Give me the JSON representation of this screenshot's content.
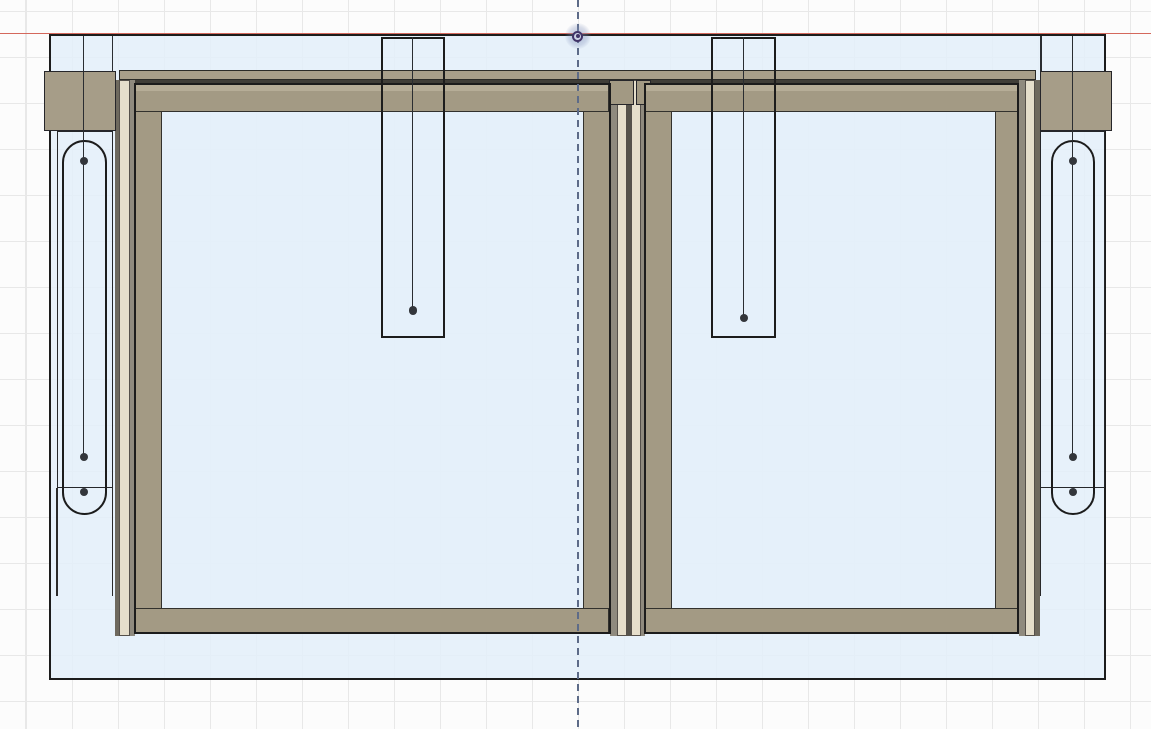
{
  "view": {
    "app_context": "cad-viewport",
    "description": "Front elevation of a double sliding door frame assembly",
    "width": 1151,
    "height": 729,
    "background_color": "#fcfcfc",
    "grid_line_color": "#e8e8e8",
    "grid_spacing_px": 46
  },
  "palette": {
    "outline_ink": "#1c1c1c",
    "body_fill": "rgba(227,239,249,0.85)",
    "glass_fill": "rgba(228,240,250,0.6)",
    "frame_tan": "#a39a84",
    "frame_tan_light": "#b6ad97",
    "block_tan": "#a69d88",
    "head_rail_tan": "#a89f8a",
    "track_cream": "#e5decb",
    "track_gray": "#8f8a7e",
    "track_dark": "#6e695e",
    "axis_line_red": "#d4685c",
    "centerline_blue": "#5d6b88",
    "sketch_point": "#33363b",
    "origin_purple": "#413468"
  },
  "origin_marker": {
    "x": 577.9,
    "y": 36.3,
    "outer_glow_radius": 13,
    "ring_radius": 5.6,
    "dot_radius": 2.2
  },
  "shapes": [
    {
      "name": "x-axis-line",
      "type": "rect",
      "x": 0,
      "y": 32.9,
      "w": 1151,
      "h": 1.6,
      "fill": "#d4685c",
      "inter": "false"
    },
    {
      "name": "assembly-body",
      "type": "rect",
      "x": 49,
      "y": 33.5,
      "w": 1057,
      "h": 646,
      "fill": "rgba(227,239,249,0.85)",
      "stroke": "#1c1c1c",
      "sw": 2,
      "inter": "false"
    },
    {
      "name": "left-bracket-edge-a",
      "type": "vline",
      "x": 57,
      "y": 487.5,
      "h": 108,
      "stroke": "#2a2a2a",
      "sw": 1.4,
      "inter": "false"
    },
    {
      "name": "left-bracket-edge-b",
      "type": "vline",
      "x": 112.6,
      "y": 487.5,
      "h": 108,
      "stroke": "#2a2a2a",
      "sw": 1.4,
      "inter": "false"
    },
    {
      "name": "right-bracket-edge",
      "type": "vline",
      "x": 1040,
      "y": 487.5,
      "h": 108,
      "stroke": "#2a2a2a",
      "sw": 1.4,
      "inter": "false"
    },
    {
      "name": "left-bracket-plate",
      "type": "rect",
      "x": 57,
      "y": 131,
      "w": 56,
      "h": 357,
      "stroke": "#25272a",
      "sw": 1.5,
      "inter": "false"
    },
    {
      "name": "right-bracket-plate",
      "type": "rect",
      "x": 1040,
      "y": 131,
      "w": 64.5,
      "h": 357,
      "stroke": "#25272a",
      "sw": 1.5,
      "inter": "false"
    },
    {
      "name": "head-rail",
      "type": "rect",
      "x": 119,
      "y": 69.8,
      "w": 917,
      "h": 9.8,
      "fill": "#a89f8a",
      "stroke": "#2b2b28",
      "sw": 1.2,
      "inter": "false"
    },
    {
      "name": "head-rail-shadow",
      "type": "rect",
      "x": 119,
      "y": 79.6,
      "w": 917,
      "h": 4.8,
      "fill": "#403e38",
      "inter": "false"
    },
    {
      "name": "left-track-dark",
      "type": "rect",
      "x": 115,
      "y": 79.5,
      "w": 4,
      "h": 556,
      "fill": "#6e695e",
      "inter": "false"
    },
    {
      "name": "left-track-cream",
      "type": "rect",
      "x": 119,
      "y": 79.5,
      "w": 10.5,
      "h": 556.5,
      "fill": "#e5decb",
      "stroke": "#55504a",
      "sw": 1,
      "inter": "false"
    },
    {
      "name": "left-track-gray",
      "type": "rect",
      "x": 129.5,
      "y": 79.5,
      "w": 5,
      "h": 556,
      "fill": "#8f8a7e",
      "inter": "false"
    },
    {
      "name": "center-track-gray-a",
      "type": "rect",
      "x": 610,
      "y": 79.5,
      "w": 6.5,
      "h": 556,
      "fill": "#8f8a7e",
      "inter": "false"
    },
    {
      "name": "center-track-cream-a",
      "type": "rect",
      "x": 616.5,
      "y": 79.5,
      "w": 10.5,
      "h": 556.5,
      "fill": "#e5decb",
      "stroke": "#55504a",
      "sw": 1,
      "inter": "false"
    },
    {
      "name": "center-track-dark",
      "type": "rect",
      "x": 627,
      "y": 79.5,
      "w": 4,
      "h": 556,
      "fill": "#55524b",
      "inter": "false"
    },
    {
      "name": "center-track-cream-b",
      "type": "rect",
      "x": 631,
      "y": 79.5,
      "w": 10,
      "h": 556.5,
      "fill": "#e5decb",
      "stroke": "#55504a",
      "sw": 1,
      "inter": "false"
    },
    {
      "name": "center-track-gray-b",
      "type": "rect",
      "x": 641,
      "y": 79.5,
      "w": 3.5,
      "h": 556,
      "fill": "#8f8a7e",
      "inter": "false"
    },
    {
      "name": "right-track-gray",
      "type": "rect",
      "x": 1018.5,
      "y": 79.5,
      "w": 6,
      "h": 556,
      "fill": "#8f8a7e",
      "inter": "false"
    },
    {
      "name": "right-track-cream",
      "type": "rect",
      "x": 1024.5,
      "y": 79.5,
      "w": 10.5,
      "h": 556.5,
      "fill": "#e5decb",
      "stroke": "#55504a",
      "sw": 1,
      "inter": "false"
    },
    {
      "name": "right-track-dark",
      "type": "rect",
      "x": 1035,
      "y": 79.5,
      "w": 5,
      "h": 556,
      "fill": "#6e695e",
      "inter": "false"
    },
    {
      "name": "left-corner-block",
      "type": "rect",
      "x": 44,
      "y": 70.8,
      "w": 71.5,
      "h": 60.5,
      "fill": "#a69d88",
      "stroke": "#26262a",
      "sw": 1.8,
      "inter": "false"
    },
    {
      "name": "right-corner-block",
      "type": "rect",
      "x": 1040,
      "y": 70.8,
      "w": 71.5,
      "h": 60.5,
      "fill": "#a69d88",
      "stroke": "#26262a",
      "sw": 1.8,
      "inter": "false"
    },
    {
      "name": "center-mullion-block-left",
      "type": "rect",
      "x": 608.5,
      "y": 80,
      "w": 25,
      "h": 24.5,
      "fill": "#a29983",
      "stroke": "#26262a",
      "sw": 1.2,
      "inter": "false"
    },
    {
      "name": "center-mullion-block-right",
      "type": "rect",
      "x": 635.5,
      "y": 80,
      "w": 15.5,
      "h": 24.5,
      "fill": "#a29983",
      "stroke": "#26262a",
      "sw": 1.2,
      "inter": "false"
    },
    {
      "name": "left-door-glass",
      "type": "rect",
      "x": 161.5,
      "y": 112,
      "w": 421.5,
      "h": 496,
      "fill": "rgba(228,240,250,0.6)",
      "inter": "false"
    },
    {
      "name": "left-door-top-rail",
      "type": "rect",
      "x": 134.5,
      "y": 84.3,
      "w": 474.5,
      "h": 27.7,
      "cls": "railtop",
      "stroke": "#32312d",
      "sw": 1.2,
      "inter": "false"
    },
    {
      "name": "left-door-bottom-rail",
      "type": "rect",
      "x": 134.5,
      "y": 608,
      "w": 474.5,
      "h": 25.8,
      "fill": "#a39a84",
      "stroke": "#32312d",
      "sw": 1.2,
      "inter": "false"
    },
    {
      "name": "left-door-left-stile",
      "type": "rect",
      "x": 134.5,
      "y": 110.5,
      "w": 27,
      "h": 498,
      "fill": "#a39a84",
      "stroke": "#32312d",
      "sw": 1.2,
      "inter": "false"
    },
    {
      "name": "left-door-right-stile",
      "type": "rect",
      "x": 583,
      "y": 110.5,
      "w": 26.5,
      "h": 498,
      "fill": "#a39a84",
      "stroke": "#32312d",
      "sw": 1.2,
      "inter": "false"
    },
    {
      "name": "left-door-outline",
      "type": "rect",
      "x": 133.5,
      "y": 83.3,
      "w": 477,
      "h": 551.2,
      "stroke": "#1c1c1c",
      "sw": 2,
      "inter": "false"
    },
    {
      "name": "right-door-glass",
      "type": "rect",
      "x": 671.5,
      "y": 112,
      "w": 323.5,
      "h": 496,
      "fill": "rgba(228,240,250,0.6)",
      "inter": "false"
    },
    {
      "name": "right-door-top-rail",
      "type": "rect",
      "x": 645,
      "y": 84.3,
      "w": 373,
      "h": 27.7,
      "cls": "railtop",
      "stroke": "#32312d",
      "sw": 1.2,
      "inter": "false"
    },
    {
      "name": "right-door-bottom-rail",
      "type": "rect",
      "x": 645,
      "y": 608,
      "w": 373,
      "h": 25.8,
      "fill": "#a39a84",
      "stroke": "#32312d",
      "sw": 1.2,
      "inter": "false"
    },
    {
      "name": "right-door-left-stile",
      "type": "rect",
      "x": 645,
      "y": 110.5,
      "w": 26.5,
      "h": 498,
      "fill": "#a39a84",
      "stroke": "#32312d",
      "sw": 1.2,
      "inter": "false"
    },
    {
      "name": "right-door-right-stile",
      "type": "rect",
      "x": 995,
      "y": 110.5,
      "w": 23.5,
      "h": 498,
      "fill": "#a39a84",
      "stroke": "#32312d",
      "sw": 1.2,
      "inter": "false"
    },
    {
      "name": "right-door-outline",
      "type": "rect",
      "x": 644,
      "y": 83.3,
      "w": 375,
      "h": 551.2,
      "stroke": "#1c1c1c",
      "sw": 2,
      "inter": "false"
    },
    {
      "name": "left-slot",
      "type": "rect",
      "x": 61.5,
      "y": 139.5,
      "w": 45,
      "h": 375.5,
      "r": 22.5,
      "stroke": "#1c1c1c",
      "sw": 2,
      "inter": "false"
    },
    {
      "name": "right-slot",
      "type": "rect",
      "x": 1050.5,
      "y": 139.5,
      "w": 44.5,
      "h": 375.5,
      "r": 22.5,
      "stroke": "#1c1c1c",
      "sw": 2,
      "inter": "false"
    },
    {
      "name": "left-slot-centerline",
      "type": "vline",
      "x": 83.4,
      "y": 35.5,
      "h": 421,
      "stroke": "#2a2d31",
      "sw": 1.6,
      "inter": "false"
    },
    {
      "name": "right-slot-centerline",
      "type": "vline",
      "x": 1072.4,
      "y": 35.5,
      "h": 421,
      "stroke": "#2a2d31",
      "sw": 1.6,
      "inter": "false"
    },
    {
      "name": "left-jamb-edge",
      "type": "vline",
      "x": 112.6,
      "y": 35.5,
      "h": 35.5,
      "stroke": "#2a2d31",
      "sw": 1.6,
      "inter": "false"
    },
    {
      "name": "right-jamb-edge",
      "type": "vline",
      "x": 1041,
      "y": 35.5,
      "h": 35.5,
      "stroke": "#2a2d31",
      "sw": 1.6,
      "inter": "false"
    },
    {
      "name": "left-hanger-outline",
      "type": "rect",
      "x": 381,
      "y": 36.5,
      "w": 64,
      "h": 301,
      "stroke": "#1c1c1c",
      "sw": 2,
      "inter": "false"
    },
    {
      "name": "right-hanger-outline",
      "type": "rect",
      "x": 711,
      "y": 36.5,
      "w": 65,
      "h": 301.5,
      "stroke": "#1c1c1c",
      "sw": 2,
      "inter": "false"
    },
    {
      "name": "left-hanger-rod",
      "type": "vline",
      "x": 412.4,
      "y": 36.5,
      "h": 274,
      "stroke": "#2a2d31",
      "sw": 1.8,
      "inter": "false"
    },
    {
      "name": "right-hanger-rod",
      "type": "vline",
      "x": 743.4,
      "y": 36.5,
      "h": 281.5,
      "stroke": "#2a2d31",
      "sw": 1.8,
      "inter": "false"
    },
    {
      "name": "left-hanger-point",
      "type": "dot",
      "x": 413.2,
      "y": 310.5,
      "rr": 4.2,
      "fill": "#33363b",
      "inter": "false"
    },
    {
      "name": "right-hanger-point",
      "type": "dot",
      "x": 744.2,
      "y": 318.2,
      "rr": 4.2,
      "fill": "#33363b",
      "inter": "false"
    },
    {
      "name": "left-slot-point-top",
      "type": "dot",
      "x": 84.2,
      "y": 160.8,
      "rr": 4,
      "fill": "#33363b",
      "inter": "false"
    },
    {
      "name": "left-slot-point-mid",
      "type": "dot",
      "x": 83.5,
      "y": 456.6,
      "rr": 4,
      "fill": "#33363b",
      "inter": "false"
    },
    {
      "name": "left-slot-point-bottom",
      "type": "dot",
      "x": 84.2,
      "y": 491.8,
      "rr": 4,
      "fill": "#33363b",
      "inter": "false"
    },
    {
      "name": "right-slot-point-top",
      "type": "dot",
      "x": 1073.2,
      "y": 160.8,
      "rr": 4,
      "fill": "#33363b",
      "inter": "false"
    },
    {
      "name": "right-slot-point-mid",
      "type": "dot",
      "x": 1073.2,
      "y": 456.6,
      "rr": 4,
      "fill": "#33363b",
      "inter": "false"
    },
    {
      "name": "right-slot-point-bottom",
      "type": "dot",
      "x": 1073.2,
      "y": 491.8,
      "rr": 4,
      "fill": "#33363b",
      "inter": "false"
    },
    {
      "name": "vertical-centerline",
      "type": "vdash",
      "x": 577.5,
      "y": 0,
      "h": 729,
      "sw": 2,
      "cls": "vdash",
      "inter": "true"
    },
    {
      "name": "origin-glow-icon",
      "type": "dot",
      "x": 577.9,
      "y": 36.3,
      "rr": 13,
      "cls": "glow",
      "inter": "false"
    },
    {
      "name": "origin-marker-icon",
      "type": "dot",
      "x": 577.9,
      "y": 36.3,
      "rr": 5.6,
      "fill": "#ccd2e4",
      "stroke": "#413468",
      "sw": 2.2,
      "inter": "true"
    },
    {
      "name": "origin-point-icon",
      "type": "dot",
      "x": 577.9,
      "y": 36.3,
      "rr": 2.2,
      "fill": "#413468",
      "inter": "true"
    }
  ]
}
